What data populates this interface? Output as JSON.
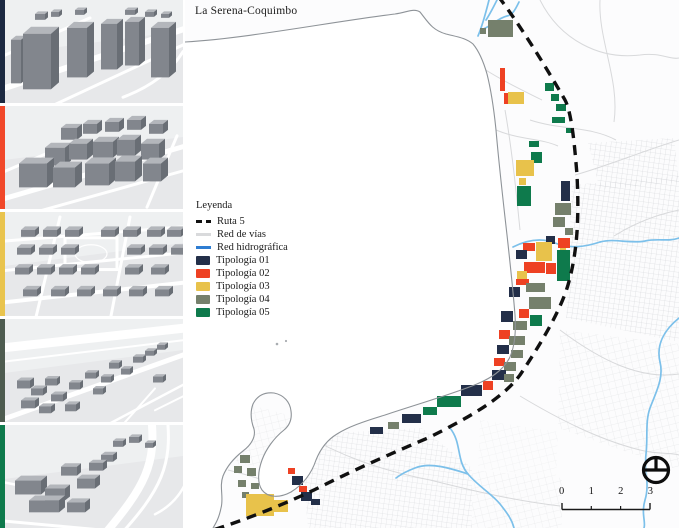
{
  "title": "La Serena-Coquimbo",
  "legend": {
    "title": "Leyenda",
    "items": [
      {
        "label": "Ruta 5",
        "symbol": "dashed-line",
        "color": "#111111"
      },
      {
        "label": "Red de vías",
        "symbol": "line",
        "color": "#d9dadc"
      },
      {
        "label": "Red hidrográfica",
        "symbol": "line",
        "color": "#2e7dd2"
      },
      {
        "label": "Tipología 01",
        "symbol": "swatch",
        "color": "#232f49"
      },
      {
        "label": "Tipología 02",
        "symbol": "swatch",
        "color": "#ee4123"
      },
      {
        "label": "Tipología 03",
        "symbol": "swatch",
        "color": "#e8c24b"
      },
      {
        "label": "Tipología 04",
        "symbol": "swatch",
        "color": "#75806c"
      },
      {
        "label": "Tipología 05",
        "symbol": "swatch",
        "color": "#0e7a4c"
      }
    ]
  },
  "sidebar": {
    "panels": [
      {
        "name": "Tipología 01 render",
        "color": "#1c2941"
      },
      {
        "name": "Tipología 02 render",
        "color": "#f1482a"
      },
      {
        "name": "Tipología 03 render",
        "color": "#e9c44e"
      },
      {
        "name": "Tipología 04 render",
        "color": "#4e5c50"
      },
      {
        "name": "Tipología 05 render",
        "color": "#0e7a4c"
      }
    ]
  },
  "map": {
    "scale_bar": {
      "ticks": [
        "0",
        "1",
        "2",
        "3"
      ]
    },
    "patches": [
      [
        488,
        20,
        25,
        17,
        4
      ],
      [
        480,
        28,
        6,
        6,
        4
      ],
      [
        500,
        68,
        5,
        23,
        2
      ],
      [
        508,
        92,
        16,
        12,
        3
      ],
      [
        504,
        93,
        4,
        11,
        2
      ],
      [
        545,
        83,
        9,
        8,
        5
      ],
      [
        551,
        94,
        8,
        7,
        5
      ],
      [
        556,
        104,
        10,
        7,
        5
      ],
      [
        552,
        117,
        13,
        6,
        5
      ],
      [
        566,
        128,
        6,
        5,
        5
      ],
      [
        529,
        141,
        10,
        6,
        5
      ],
      [
        531,
        152,
        11,
        11,
        5
      ],
      [
        516,
        160,
        18,
        16,
        3
      ],
      [
        519,
        178,
        7,
        7,
        3
      ],
      [
        517,
        186,
        14,
        20,
        5
      ],
      [
        561,
        181,
        9,
        20,
        1
      ],
      [
        555,
        203,
        16,
        12,
        4
      ],
      [
        553,
        217,
        12,
        10,
        4
      ],
      [
        565,
        228,
        8,
        7,
        4
      ],
      [
        558,
        238,
        12,
        10,
        2
      ],
      [
        546,
        236,
        9,
        8,
        1
      ],
      [
        523,
        243,
        12,
        8,
        2
      ],
      [
        536,
        242,
        16,
        19,
        3
      ],
      [
        560,
        248,
        6,
        6,
        3
      ],
      [
        516,
        250,
        11,
        9,
        1
      ],
      [
        524,
        262,
        21,
        11,
        2
      ],
      [
        557,
        250,
        13,
        31,
        5
      ],
      [
        546,
        263,
        10,
        11,
        2
      ],
      [
        517,
        271,
        10,
        8,
        3
      ],
      [
        516,
        279,
        13,
        6,
        2
      ],
      [
        526,
        283,
        19,
        9,
        4
      ],
      [
        509,
        287,
        11,
        10,
        1
      ],
      [
        529,
        297,
        22,
        12,
        4
      ],
      [
        519,
        309,
        10,
        9,
        2
      ],
      [
        501,
        311,
        12,
        11,
        1
      ],
      [
        513,
        321,
        14,
        9,
        4
      ],
      [
        530,
        315,
        12,
        11,
        5
      ],
      [
        499,
        330,
        11,
        9,
        2
      ],
      [
        509,
        336,
        16,
        9,
        4
      ],
      [
        497,
        345,
        12,
        9,
        1
      ],
      [
        511,
        350,
        12,
        8,
        4
      ],
      [
        494,
        358,
        11,
        8,
        2
      ],
      [
        504,
        362,
        12,
        9,
        4
      ],
      [
        492,
        370,
        14,
        10,
        1
      ],
      [
        504,
        374,
        10,
        8,
        4
      ],
      [
        483,
        381,
        10,
        9,
        2
      ],
      [
        461,
        385,
        21,
        11,
        1
      ],
      [
        437,
        396,
        24,
        11,
        5
      ],
      [
        423,
        407,
        14,
        8,
        5
      ],
      [
        402,
        414,
        19,
        9,
        1
      ],
      [
        388,
        422,
        11,
        7,
        4
      ],
      [
        370,
        427,
        13,
        7,
        1
      ],
      [
        240,
        455,
        10,
        8,
        4
      ],
      [
        234,
        466,
        8,
        7,
        4
      ],
      [
        247,
        468,
        9,
        8,
        4
      ],
      [
        238,
        480,
        8,
        7,
        4
      ],
      [
        251,
        483,
        8,
        6,
        4
      ],
      [
        242,
        492,
        7,
        6,
        4
      ],
      [
        246,
        494,
        28,
        22,
        3
      ],
      [
        272,
        500,
        16,
        12,
        3
      ],
      [
        288,
        468,
        7,
        6,
        2
      ],
      [
        292,
        476,
        11,
        9,
        1
      ],
      [
        299,
        486,
        8,
        6,
        2
      ],
      [
        301,
        492,
        11,
        9,
        1
      ],
      [
        311,
        499,
        9,
        6,
        1
      ]
    ]
  }
}
